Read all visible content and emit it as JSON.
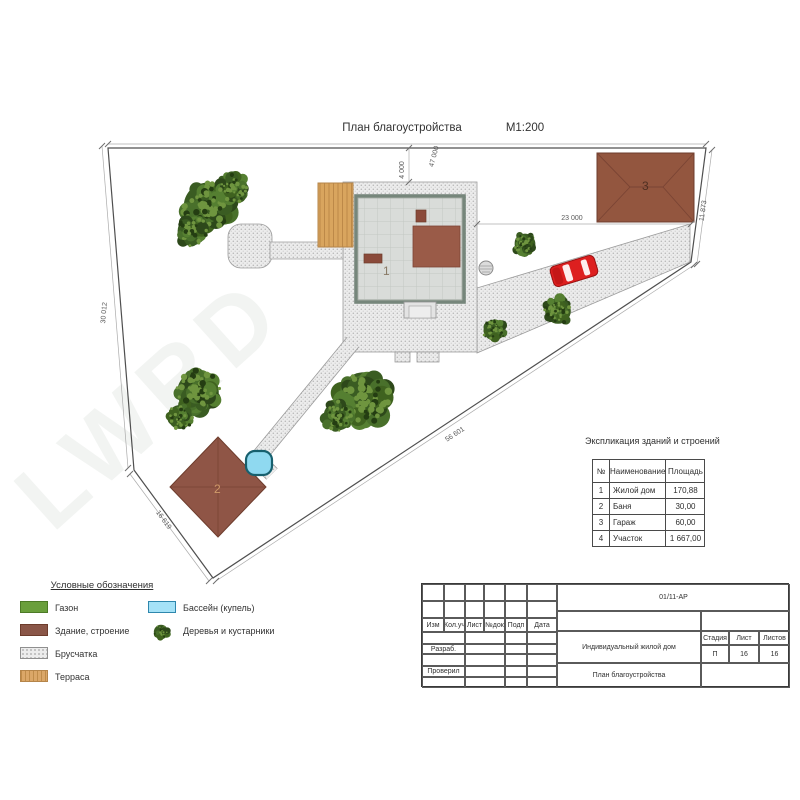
{
  "header": {
    "title": "План благоустройства",
    "scale": "М1:200"
  },
  "watermark": "LWRD",
  "dimensions": {
    "top": "47 000",
    "house_offset": "4 000",
    "left": "30 012",
    "bottom_left": "16 619",
    "diagonal": "56 601",
    "garage_offset": "23 000",
    "right": "11 873"
  },
  "buildings": {
    "house": "1",
    "bath": "2",
    "garage": "3"
  },
  "legend": {
    "title": "Условные обозначения",
    "items": [
      {
        "key": "lawn",
        "label": "Газон"
      },
      {
        "key": "building",
        "label": "Здание, строение"
      },
      {
        "key": "paving",
        "label": "Брусчатка"
      },
      {
        "key": "terrace",
        "label": "Терраса"
      },
      {
        "key": "pool",
        "label": "Бассейн (купель)"
      },
      {
        "key": "trees",
        "label": "Деревья и кустарники"
      }
    ]
  },
  "explication": {
    "title": "Экспликация зданий и строений",
    "headers": [
      "№",
      "Наименование",
      "Площадь"
    ],
    "rows": [
      {
        "num": "1",
        "name": "Жилой дом",
        "area": "170,88"
      },
      {
        "num": "2",
        "name": "Баня",
        "area": "30,00"
      },
      {
        "num": "3",
        "name": "Гараж",
        "area": "60,00"
      },
      {
        "num": "4",
        "name": "Участок",
        "area": "1 667,00"
      }
    ]
  },
  "titleblock": {
    "doc_number": "01/11-АР",
    "revision_columns": [
      "Изм",
      "Кол.уч",
      "Лист",
      "№док",
      "Подп",
      "Дата"
    ],
    "role_rows": [
      "Разраб.",
      "Проверил"
    ],
    "project_name": "Индивидуальный жилой дом",
    "sheet_title": "План благоустройства",
    "stage_columns": [
      "Стадия",
      "Лист",
      "Листов"
    ],
    "stage_values": [
      "П",
      "16",
      "16"
    ]
  },
  "colors": {
    "roof_brown": "#8f5546",
    "paving_gray": "#ececec",
    "lawn_green": "#6a9f3c",
    "pool_blue": "#8fd9f0",
    "terrace_tan": "#dba768",
    "car_red": "#dd1f1f"
  }
}
